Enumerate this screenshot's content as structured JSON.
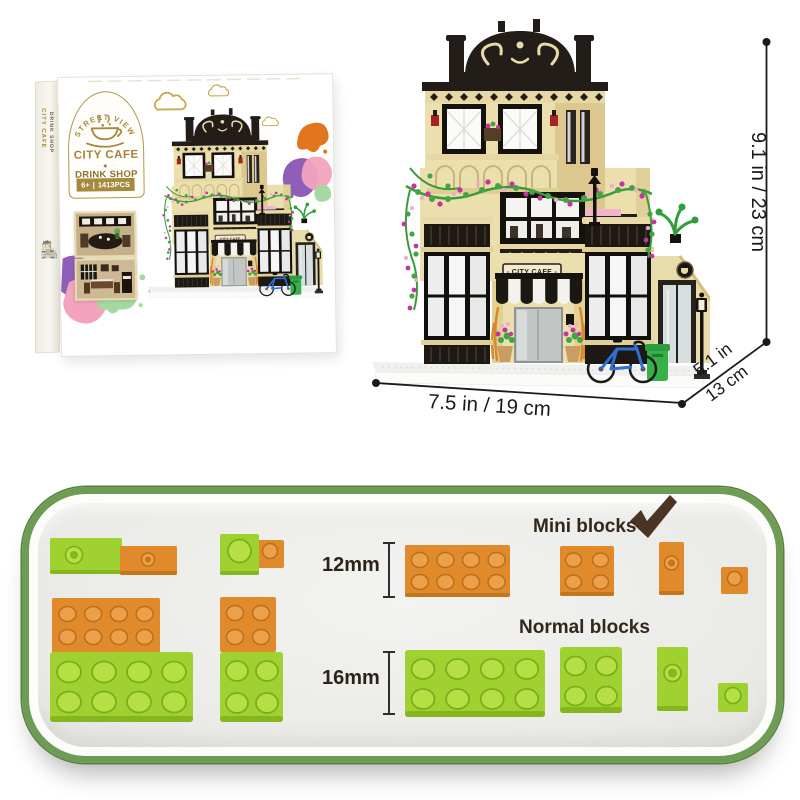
{
  "product": {
    "box": {
      "spine": {
        "line1": "CITY CAFE",
        "line2": "DRINK SHOP"
      },
      "logo": {
        "arc_text": "STREET VIEW",
        "title": "CITY CAFE",
        "divider": "· ◆ ·",
        "subtitle": "DRINK SHOP",
        "badge": {
          "age": "6+",
          "separator": "|",
          "pieces": "1413PCS"
        }
      }
    },
    "building_sign": "- CITY CAFE -"
  },
  "dimensions": {
    "height_label": "9.1 in / 23 cm",
    "width_label": "7.5 in / 19 cm",
    "depth_label_in": "5.1 in",
    "depth_label_cm": "13 cm"
  },
  "block_comparison": {
    "mini_title": "Mini blocks",
    "mini_height": "12mm",
    "normal_title": "Normal blocks",
    "normal_height": "16mm"
  },
  "icons": {
    "checkmark": "✔",
    "coffee_cup": "coffee-cup"
  },
  "colors": {
    "mini_block_orange": "#E08A2B",
    "normal_block_green": "#9FD230",
    "panel_border_green": "#6F9C55",
    "panel_background": "#ECECEA",
    "logo_gold": "#A5893C",
    "label_brown": "#33271B",
    "dimension_text": "#1A1A1A",
    "building_cream": "#ECDFAE",
    "roof_black": "#221D18",
    "bicycle_blue": "#2E6FD6",
    "splash_purple": "#8F5EB8",
    "splash_pink": "#F2A3BD",
    "splash_orange": "#E2751F",
    "splash_green": "#A6D8A2"
  }
}
